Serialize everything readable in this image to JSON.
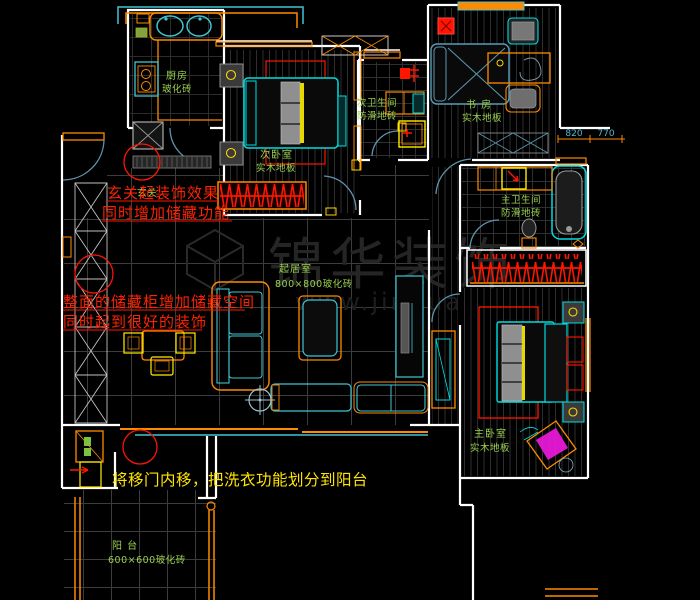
{
  "title": "apartment-floor-plan",
  "rooms": {
    "entry": {
      "name": "玄关"
    },
    "kitchen": {
      "name": "厨房",
      "material": "玻化砖"
    },
    "bedroom2": {
      "name": "次卧室",
      "material": "实木地板"
    },
    "bath2": {
      "name": "次卫生间",
      "material": "防滑地砖"
    },
    "study": {
      "name": "书 房",
      "material": "实木地板"
    },
    "master_bath": {
      "name": "主卫生间",
      "material": "防滑地砖"
    },
    "living": {
      "name": "起居室",
      "material": "800×800玻化砖"
    },
    "master_bedroom": {
      "name": "主卧室",
      "material": "实木地板"
    },
    "balcony": {
      "name": "阳 台",
      "material": "600×600玻化砖"
    }
  },
  "annotations": {
    "entry_note": [
      "玄关起装饰效果",
      "同时增加储藏功能"
    ],
    "storage_note": [
      "整面的储藏柜增加储藏空间",
      "同时起到很好的装饰"
    ],
    "laundry_note": "将移门内移，把洗衣功能划分到阳台"
  },
  "dimensions": {
    "left": "820",
    "right": "770"
  },
  "watermark": {
    "brand": "锦华装饰",
    "url": "www.jinhua"
  },
  "colors": {
    "wall": "#ffffff",
    "furniture_cyan": "#00dde0",
    "furniture_orange": "#ff8a00",
    "accent_yellow": "#ffee00",
    "highlight_red": "#ff1500",
    "label_green": "#9ad04f",
    "note_yellow": "#ffe400",
    "dim_cyan": "#4fb7d0",
    "magenta": "#f21ae0"
  }
}
